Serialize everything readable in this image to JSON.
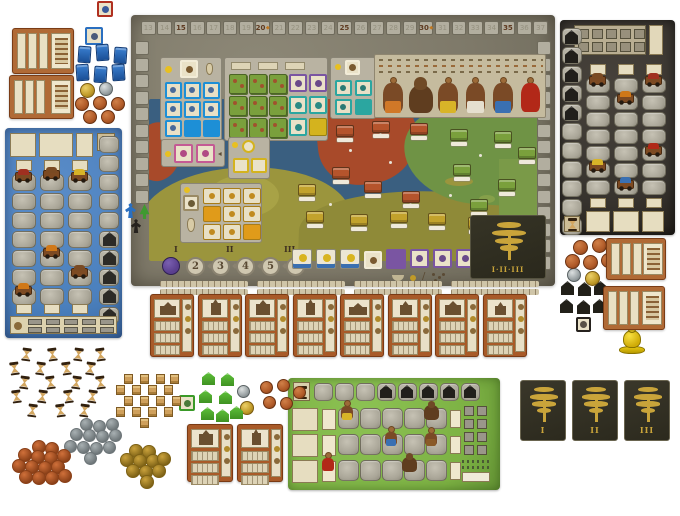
{
  "scene": {
    "description": "Historical civilization board game fully set up on a white table"
  },
  "main_board": {
    "score_track": {
      "cells": [
        "13",
        "14",
        "15",
        "16",
        "17",
        "18",
        "19",
        "20",
        "21",
        "22",
        "23",
        "24",
        "25",
        "26",
        "27",
        "28",
        "29",
        "30",
        "31",
        "32",
        "33",
        "34",
        "35",
        "36",
        "37"
      ],
      "bold_numbers": [
        "15",
        "20",
        "25",
        "30",
        "35"
      ],
      "diamond_numbers": [
        "20",
        "30"
      ],
      "diamond_glyph": "◆"
    },
    "round_track": {
      "space_numbers": [
        "2",
        "3",
        "4",
        "5",
        "6"
      ],
      "phase_labels": [
        "I",
        "II",
        "III"
      ],
      "marker_color": "#5a3f8e"
    },
    "tree_panel_label": "I·II·III",
    "grids": {
      "blue_tiles": 9,
      "blue_solid": 2,
      "orange_tiles": 9,
      "orange_solid": 2,
      "teal_tiles": 4,
      "purple_row_tiles": 5,
      "pink_tiles": 2,
      "yellow_tiles": 2,
      "white_gold_tiles": 3,
      "city_stack_tiles": 9
    },
    "character_figures": 6,
    "city_tokens": {
      "red": 6,
      "green": 6,
      "yellow": 6
    }
  },
  "player_markers": {
    "colors": [
      "#2a6fc0",
      "#3f9a30",
      "#26221e"
    ]
  },
  "boards": {
    "blue_player_board": 1,
    "black_player_board": 1,
    "green_expansion_board": 1
  },
  "building_cards_row": {
    "count": 8
  },
  "building_cards_mid": {
    "count": 2
  },
  "aid_cards": {
    "top_left": 2,
    "right": 2
  },
  "tree_cards": {
    "labels": [
      "I",
      "II",
      "III"
    ]
  },
  "tokens": {
    "blue_blocks": 6,
    "hourglasses": 19,
    "crates": 17,
    "green_houses": 7,
    "black_houses_supply": 7,
    "gray_discs": 12,
    "orange_discs": 14,
    "gold_discs": 10,
    "coins_top_left": {
      "gold": 1,
      "silver": 1,
      "copper": 5
    },
    "coins_mid": {
      "gold": 1,
      "silver": 1,
      "copper": 5
    },
    "coins_right": {
      "gold": 1,
      "silver": 1,
      "copper": 5
    },
    "yellow_bell": 1
  },
  "colors": {
    "sea": "#3a5f80",
    "land_olive": "#9b953d",
    "land_olive2": "#8f8a38",
    "land_red": "#a84a2a",
    "land_green": "#6f9345",
    "board_stone": "#827d6c",
    "blue_board": "#4b80bd",
    "dark_board": "#37332e",
    "green_board": "#7cb143",
    "tile_blue": "#1d8fd6",
    "tile_orange": "#e09b1a",
    "tile_teal": "#2ba6a0",
    "tile_purple": "#7a55a2",
    "tile_pink": "#c45a94",
    "tile_yellow": "#d4b31e",
    "card_rust": "#a85a28",
    "gold": "#c9a43a",
    "city_red": "#b5542c",
    "city_green": "#7aa03c",
    "city_yellow": "#c2a22c"
  }
}
